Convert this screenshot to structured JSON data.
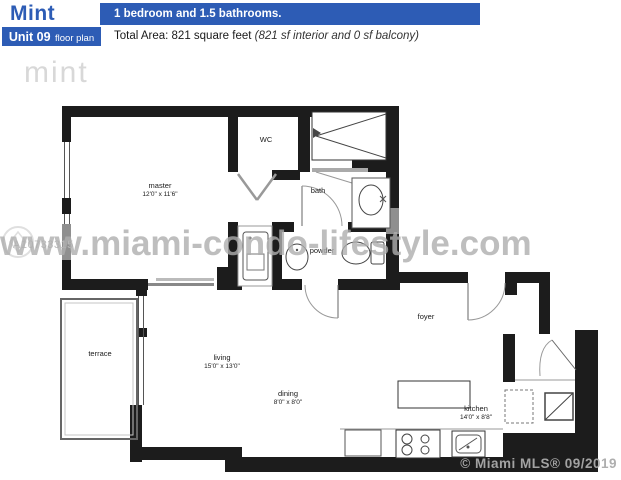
{
  "header": {
    "brand": "Mint",
    "summary": "1 bedroom and 1.5 bathrooms.",
    "unit": "Unit 09",
    "unit_suffix": "floor plan",
    "total_area": "Total Area: 821 square feet",
    "total_area_detail": "(821 sf interior and 0 sf balcony)"
  },
  "logo": {
    "text": "mint"
  },
  "rooms": {
    "master": {
      "name": "master",
      "dims": "12'0\" x 11'6\""
    },
    "wc": {
      "name": "WC"
    },
    "bath": {
      "name": "bath"
    },
    "powder": {
      "name": "powder"
    },
    "terrace": {
      "name": "terrace"
    },
    "living": {
      "name": "living",
      "dims": "15'0\" x 13'0\""
    },
    "dining": {
      "name": "dining",
      "dims": "8'0\" x 8'0\""
    },
    "foyer": {
      "name": "foyer"
    },
    "kitchen": {
      "name": "kitchen",
      "dims": "14'0\" x 8'8\""
    }
  },
  "watermarks": {
    "site": "www.miami-condo-lifestyle.com",
    "mls_id": "A10733315",
    "credit": "© Miami MLS® 09/2019"
  },
  "colors": {
    "accent": "#2d5cb5",
    "wall": "#1c1c1c",
    "watermark": "#afafaf"
  }
}
